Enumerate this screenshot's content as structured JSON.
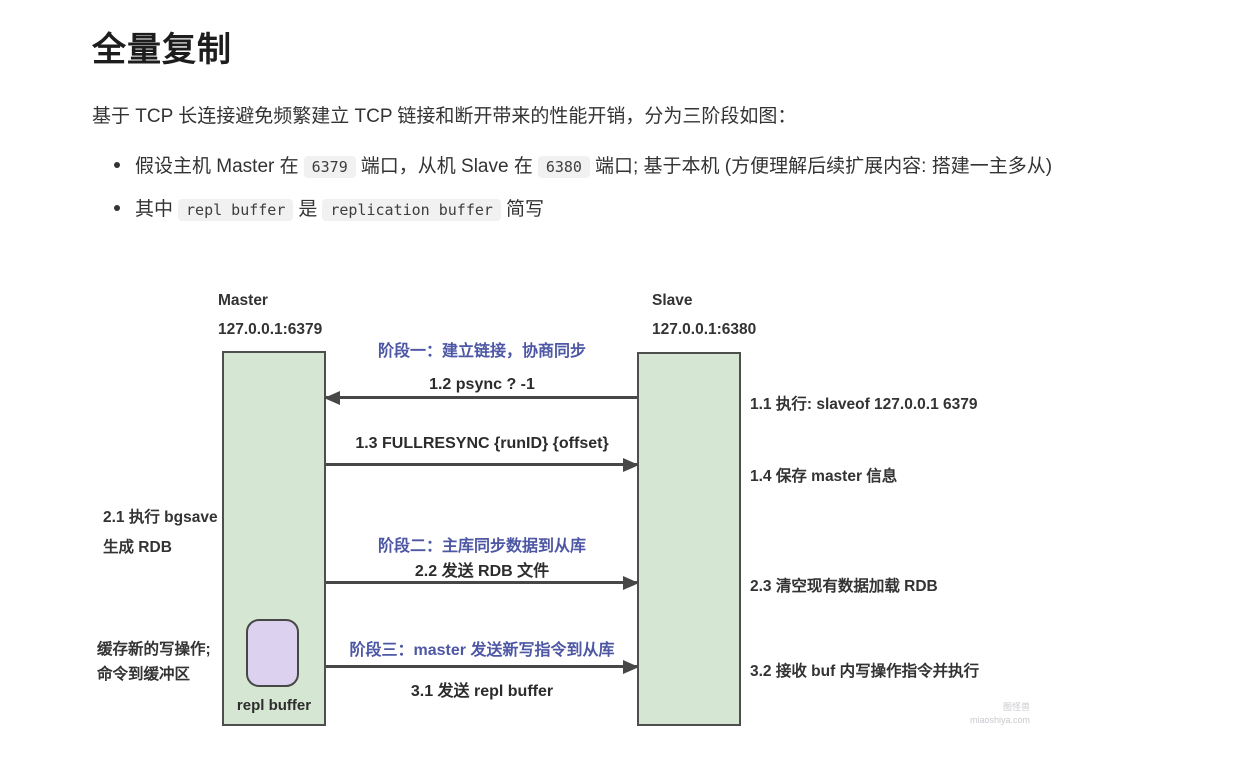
{
  "content": {
    "title": "全量复制",
    "intro": "基于 TCP 长连接避免频繁建立 TCP 链接和断开带来的性能开销，分为三阶段如图：",
    "bullets": [
      {
        "segments": [
          {
            "t": "text",
            "v": "假设主机 Master 在"
          },
          {
            "t": "code",
            "v": "6379"
          },
          {
            "t": "text",
            "v": "端口，从机 Slave 在"
          },
          {
            "t": "code",
            "v": "6380"
          },
          {
            "t": "text",
            "v": "端口; 基于本机 (方便理解后续扩展内容: 搭建一主多从)"
          }
        ]
      },
      {
        "segments": [
          {
            "t": "text",
            "v": "其中"
          },
          {
            "t": "code",
            "v": "repl buffer"
          },
          {
            "t": "text",
            "v": "是"
          },
          {
            "t": "code",
            "v": "replication buffer"
          },
          {
            "t": "text",
            "v": "简写"
          }
        ]
      }
    ]
  },
  "diagram": {
    "master": {
      "name": "Master",
      "address": "127.0.0.1:6379",
      "buffer_label": "repl buffer"
    },
    "slave": {
      "name": "Slave",
      "address": "127.0.0.1:6380"
    },
    "phase_labels": [
      "阶段一：建立链接，协商同步",
      "阶段二：主库同步数据到从库",
      "阶段三：master 发送新写指令到从库"
    ],
    "messages": [
      {
        "label": "1.2  psync ? -1",
        "direction": "left"
      },
      {
        "label": "1.3 FULLRESYNC {runID} {offset}",
        "direction": "right"
      },
      {
        "label": "2.2 发送 RDB 文件",
        "direction": "right"
      },
      {
        "label": "3.1 发送 repl buffer",
        "direction": "right"
      }
    ],
    "left_notes": [
      {
        "lines": [
          "2.1 执行 bgsave",
          "生成 RDB"
        ]
      },
      {
        "lines": [
          "缓存新的写操作;",
          "命令到缓冲区"
        ]
      }
    ],
    "right_notes": [
      "1.1 执行: slaveof 127.0.0.1 6379",
      "1.4 保存 master 信息",
      "2.3 清空现有数据加载 RDB",
      "3.2 接收 buf 内写操作指令并执行"
    ],
    "colors": {
      "node_fill": "#d5e7d2",
      "node_border": "#4d4f4c",
      "buffer_fill": "#dcd2f0",
      "phase_text": "#4d57a4",
      "arrow": "#474747"
    }
  },
  "watermark": {
    "line1": "图怪兽",
    "line2": "miaoshiya.com"
  }
}
